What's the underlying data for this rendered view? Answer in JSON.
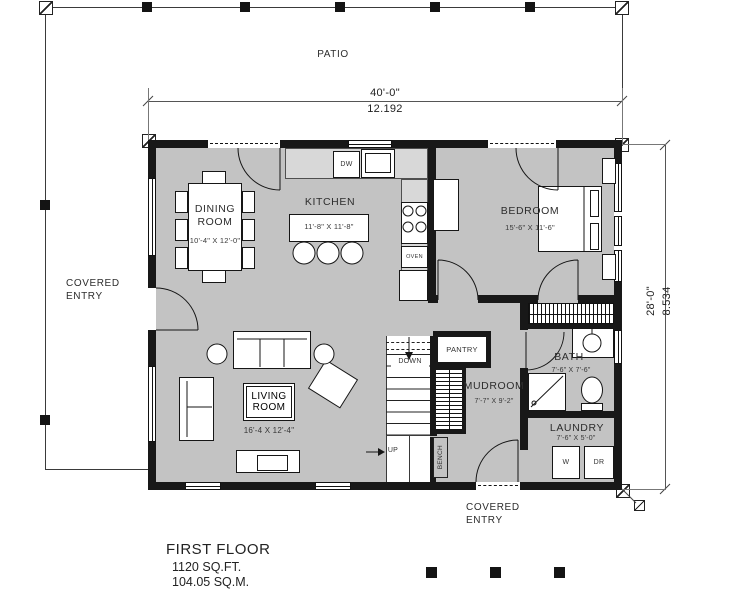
{
  "site": {
    "patio": "PATIO",
    "covered_entry_left": "COVERED ENTRY",
    "covered_entry_bottom": "COVERED ENTRY"
  },
  "dimensions": {
    "overall_width_ft": "40'-0\"",
    "overall_width_m": "12.192",
    "overall_depth_ft": "28'-0\"",
    "overall_depth_m": "8.534"
  },
  "rooms": {
    "dining": {
      "name": "DINING ROOM",
      "dims": "10'-4\" X 12'-0\""
    },
    "kitchen": {
      "name": "KITCHEN",
      "dims": "11'-8\" X 11'-8\""
    },
    "bedroom": {
      "name": "BEDROOM",
      "dims": "15'-6\" X 11'-6\""
    },
    "living": {
      "name": "LIVING ROOM",
      "dims": "16'-4 X 12'-4\""
    },
    "bath": {
      "name": "BATH",
      "dims": "7'-6\" X 7'-6\""
    },
    "mudroom": {
      "name": "MUDROOM",
      "dims": "7'-7\" X 9'-2\""
    },
    "laundry": {
      "name": "LAUNDRY",
      "dims": "7'-6\" X 5'-0\""
    }
  },
  "fixtures": {
    "dishwasher": "DW",
    "oven": "OVEN",
    "washer": "W",
    "dryer": "DR",
    "pantry": "PANTRY",
    "bench": "BENCH",
    "stairs_down": "DOWN",
    "stairs_up": "UP"
  },
  "footer": {
    "floor_name": "FIRST FLOOR",
    "area_sqft": "1120 SQ.FT.",
    "area_sqm": "104.05 SQ.M."
  },
  "colors": {
    "floor": "#c3c3c3",
    "counter": "#d8d8d8",
    "wall": "#181818"
  }
}
